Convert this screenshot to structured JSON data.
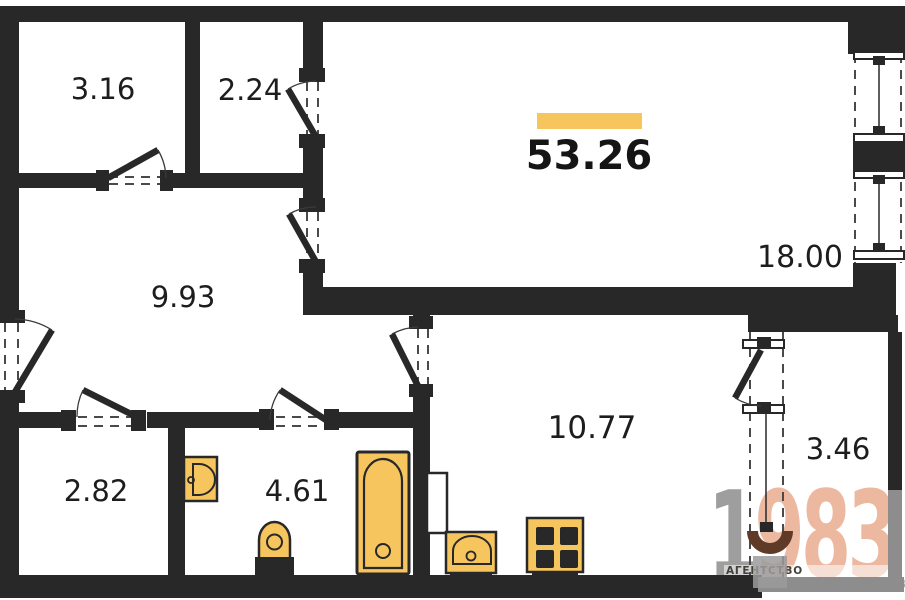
{
  "plan": {
    "type": "apartment-floor-plan",
    "total_area_label": "53.26",
    "rooms": [
      {
        "area_label": "3.16"
      },
      {
        "area_label": "2.24"
      },
      {
        "area_label": "9.93"
      },
      {
        "area_label": "2.82"
      },
      {
        "area_label": "4.61"
      },
      {
        "area_label": "10.77"
      },
      {
        "area_label": "18.00"
      },
      {
        "area_label": "3.46"
      }
    ],
    "fixtures": [
      "bathroom-sink",
      "toilet",
      "bathtub",
      "kitchen-sink",
      "stove"
    ],
    "features": [
      "entrance-door",
      "balcony-door",
      "balcony-window",
      "two-facade-windows",
      "duct-shaft"
    ]
  },
  "watermark": {
    "digits_gray": "1",
    "digits_salmon": "983",
    "caption_line1": "АГЕНТСТВО",
    "caption_line2_bold": "НЕДВИЖИМ",
    "caption_line2_rest": "ОСТИ И ИНВЕСТИЦИЙ"
  },
  "colors": {
    "wall": "#282828",
    "fixture": "#f7c55e",
    "accent": "#f7c55e",
    "balcony-wall": "#8d8d8d",
    "wm-gray": "#9e9e9e",
    "wm-salmon": "#ecb9a0",
    "wm-brown": "#5f3b27",
    "caption-dark": "#44403a",
    "caption-light": "#a6a6a6",
    "text": "#1d1d1d"
  }
}
